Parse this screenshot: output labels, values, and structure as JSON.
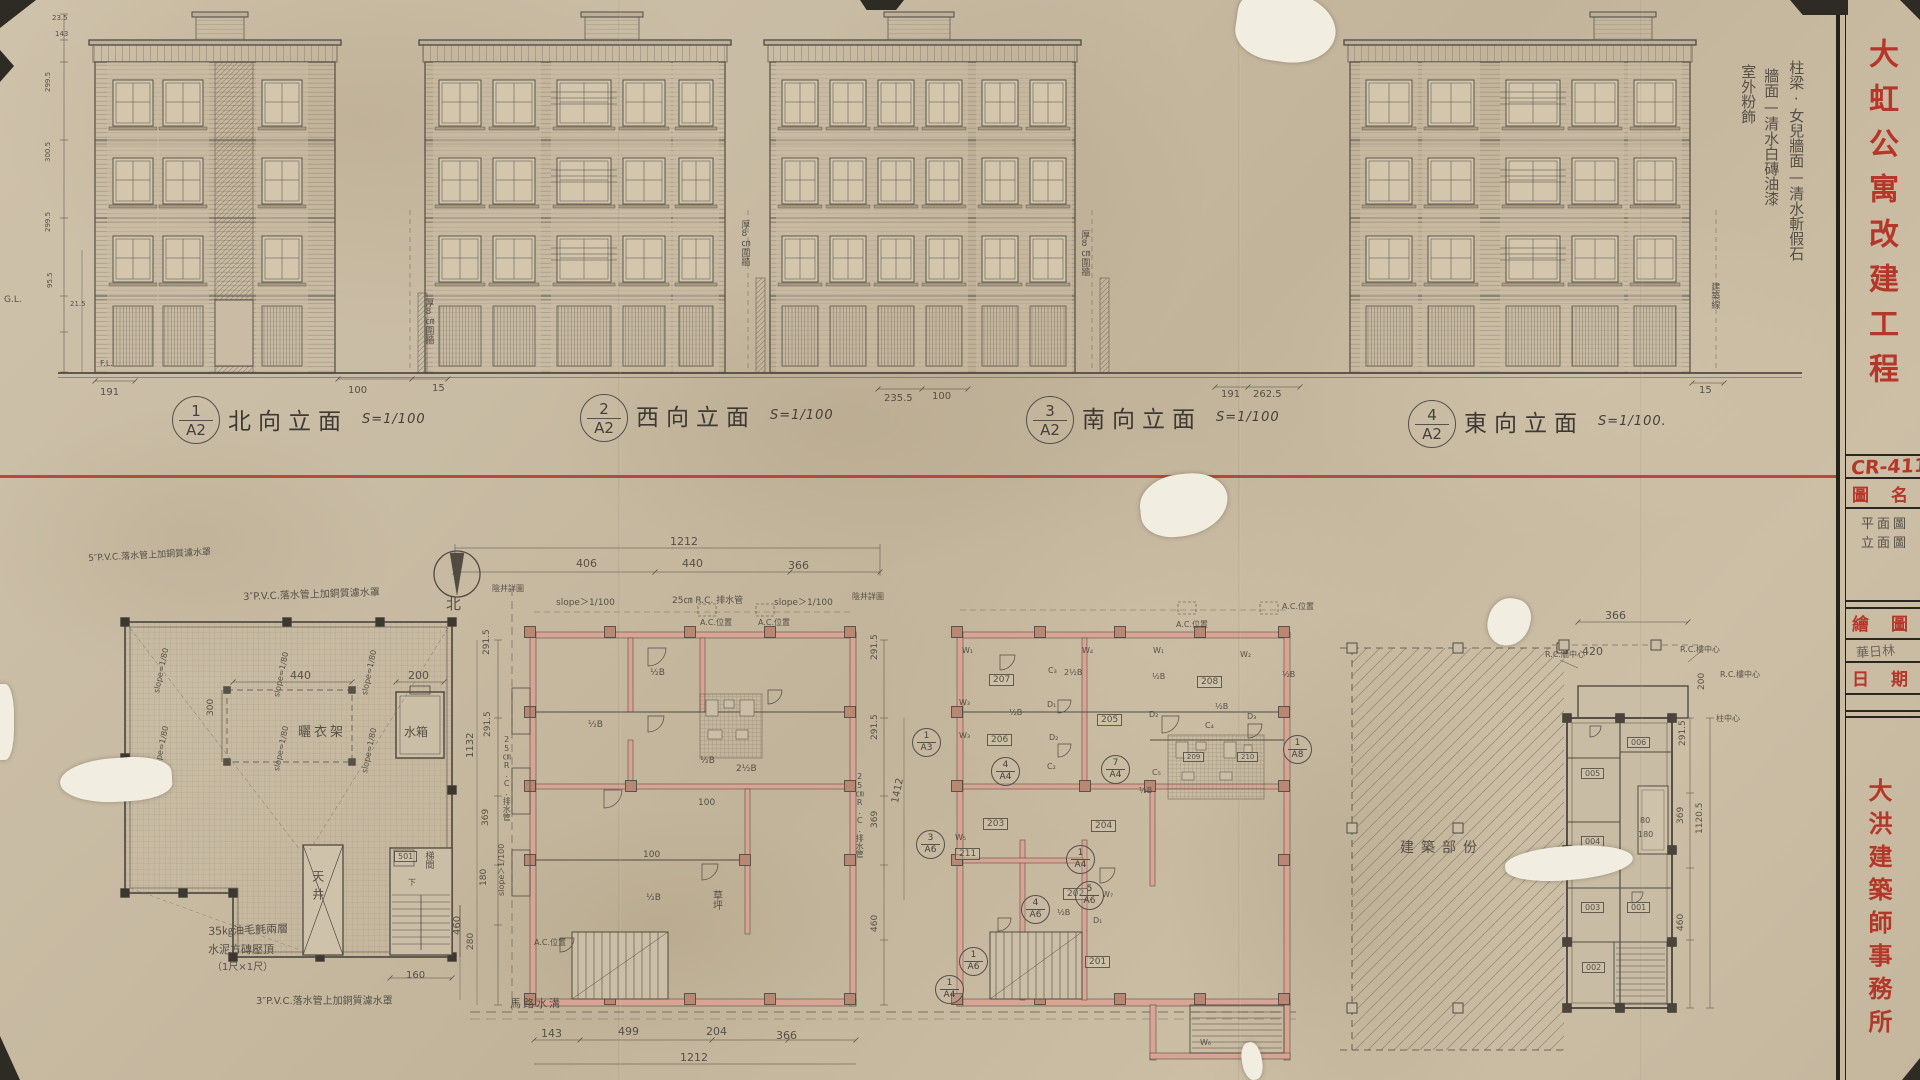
{
  "sheet": {
    "project_title": "大虹公寓改建工程",
    "drawing_no": "CR-411",
    "title_block": {
      "drawing_name_label": "圖名",
      "drawing_name_line1": "平面圖",
      "drawing_name_line2": "立面圖",
      "drafter_label": "繪圖",
      "drafter_name": "華日林",
      "date_label": "日期",
      "firm_name": "大洪建築師事務所"
    },
    "colors": {
      "red_ink": "#b5372a",
      "pencil": "#4d4840",
      "wall_fill": "#d8a595",
      "paper": "#c8baa2"
    }
  },
  "elevations": [
    {
      "num": "1",
      "sheet": "A2",
      "title": "北向立面",
      "scale": "S=1/100"
    },
    {
      "num": "2",
      "sheet": "A2",
      "title": "西向立面",
      "scale": "S=1/100"
    },
    {
      "num": "3",
      "sheet": "A2",
      "title": "南向立面",
      "scale": "S=1/100"
    },
    {
      "num": "4",
      "sheet": "A2",
      "title": "東向立面",
      "scale": "S=1/100."
    }
  ],
  "refs": [
    {
      "n": "1",
      "s": "A2",
      "x": 172,
      "y": 396,
      "d": 46,
      "nm": "elevation-ref-1"
    },
    {
      "n": "2",
      "s": "A2",
      "x": 580,
      "y": 394,
      "d": 46,
      "nm": "elevation-ref-2"
    },
    {
      "n": "3",
      "s": "A2",
      "x": 1026,
      "y": 396,
      "d": 46,
      "nm": "elevation-ref-3"
    },
    {
      "n": "4",
      "s": "A2",
      "x": 1408,
      "y": 400,
      "d": 46,
      "nm": "elevation-ref-4"
    },
    {
      "n": "1",
      "s": "A3",
      "x": 912,
      "y": 728,
      "d": 27
    },
    {
      "n": "3",
      "s": "A6",
      "x": 916,
      "y": 830,
      "d": 27
    },
    {
      "n": "1",
      "s": "A4",
      "x": 1066,
      "y": 845,
      "d": 27
    },
    {
      "n": "5",
      "s": "A6",
      "x": 1075,
      "y": 881,
      "d": 27
    },
    {
      "n": "4",
      "s": "A6",
      "x": 1021,
      "y": 895,
      "d": 27
    },
    {
      "n": "1",
      "s": "A6",
      "x": 959,
      "y": 947,
      "d": 27
    },
    {
      "n": "1",
      "s": "A4",
      "x": 935,
      "y": 975,
      "d": 27
    },
    {
      "n": "4",
      "s": "A4",
      "x": 991,
      "y": 757,
      "d": 27
    },
    {
      "n": "7",
      "s": "A4",
      "x": 1101,
      "y": 755,
      "d": 27
    },
    {
      "n": "1",
      "s": "A8",
      "x": 1283,
      "y": 735,
      "d": 27
    }
  ],
  "annotations": [
    {
      "t": "柱梁·女兒牆面—清水斬假石",
      "x": 1787,
      "y": 60,
      "v": 1,
      "s": 15,
      "n": "finish-note-structure"
    },
    {
      "t": "牆面—清水白磚油漆",
      "x": 1762,
      "y": 68,
      "v": 1,
      "s": 15,
      "n": "finish-note-wall"
    },
    {
      "t": "室外粉飾",
      "x": 1739,
      "y": 64,
      "v": 1,
      "s": 15,
      "n": "finish-note-exterior"
    },
    {
      "t": "G.L.",
      "x": 4,
      "y": 295,
      "s": 9
    },
    {
      "t": "F.L.",
      "x": 100,
      "y": 359,
      "s": 8
    },
    {
      "t": "23.5",
      "x": 52,
      "y": 14,
      "s": 7
    },
    {
      "t": "143",
      "x": 55,
      "y": 30,
      "s": 7
    },
    {
      "t": "299.5",
      "x": 44,
      "y": 92,
      "r": -90,
      "s": 7
    },
    {
      "t": "300.5",
      "x": 44,
      "y": 162,
      "r": -90,
      "s": 7
    },
    {
      "t": "299.5",
      "x": 44,
      "y": 232,
      "r": -90,
      "s": 7
    },
    {
      "t": "95.5",
      "x": 46,
      "y": 288,
      "r": -90,
      "s": 7
    },
    {
      "t": "21.5",
      "x": 70,
      "y": 300,
      "s": 7
    },
    {
      "t": "191",
      "x": 100,
      "y": 387,
      "s": 10
    },
    {
      "t": "100",
      "x": 348,
      "y": 385,
      "s": 10
    },
    {
      "t": "15",
      "x": 432,
      "y": 383,
      "s": 10
    },
    {
      "t": "235.5",
      "x": 884,
      "y": 393,
      "s": 10
    },
    {
      "t": "100",
      "x": 932,
      "y": 391,
      "s": 10
    },
    {
      "t": "191",
      "x": 1221,
      "y": 389,
      "s": 10
    },
    {
      "t": "262.5",
      "x": 1253,
      "y": 389,
      "s": 10
    },
    {
      "t": "15",
      "x": 1699,
      "y": 385,
      "s": 10
    },
    {
      "t": "厚8㎝圍牆",
      "x": 423,
      "y": 298,
      "v": 1,
      "s": 9
    },
    {
      "t": "厚8㎝圍牆",
      "x": 739,
      "y": 220,
      "v": 1,
      "s": 9
    },
    {
      "t": "厚8㎝圍牆",
      "x": 1079,
      "y": 230,
      "v": 1,
      "s": 9
    },
    {
      "t": "建築線",
      "x": 1709,
      "y": 282,
      "v": 1,
      "s": 9
    },
    {
      "t": "5″P.V.C.落水管上加銅質濾水罩",
      "x": 88,
      "y": 554,
      "s": 9,
      "r": -3
    },
    {
      "t": "3″P.V.C.落水管上加銅質濾水罩",
      "x": 243,
      "y": 592,
      "s": 10,
      "r": -2
    },
    {
      "t": "3″P.V.C.落水管上加銅質濾水罩",
      "x": 256,
      "y": 996,
      "s": 10
    },
    {
      "t": "440",
      "x": 290,
      "y": 670,
      "s": 11
    },
    {
      "t": "200",
      "x": 408,
      "y": 670,
      "s": 11
    },
    {
      "t": "300",
      "x": 206,
      "y": 716,
      "r": -90,
      "s": 9
    },
    {
      "t": "160",
      "x": 406,
      "y": 970,
      "s": 10
    },
    {
      "t": "460",
      "x": 452,
      "y": 935,
      "r": -90,
      "s": 10
    },
    {
      "t": "slope=1/80",
      "x": 152,
      "y": 692,
      "r": -78,
      "s": 8
    },
    {
      "t": "slope=1/80",
      "x": 272,
      "y": 696,
      "r": -78,
      "s": 8
    },
    {
      "t": "slope=1/80",
      "x": 360,
      "y": 694,
      "r": -78,
      "s": 8
    },
    {
      "t": "slope=1/80",
      "x": 152,
      "y": 770,
      "r": -78,
      "s": 8
    },
    {
      "t": "slope=1/80",
      "x": 272,
      "y": 770,
      "r": -78,
      "s": 8
    },
    {
      "t": "slope=1/80",
      "x": 360,
      "y": 772,
      "r": -78,
      "s": 8
    },
    {
      "t": "曬衣架",
      "x": 298,
      "y": 726,
      "s": 13,
      "ls": 3
    },
    {
      "t": "水箱",
      "x": 404,
      "y": 726,
      "s": 12
    },
    {
      "t": "天井",
      "x": 310,
      "y": 870,
      "v": 1,
      "s": 12,
      "ls": 6
    },
    {
      "t": "501",
      "x": 394,
      "y": 851,
      "b": 1,
      "s": 8
    },
    {
      "t": "梯間",
      "x": 423,
      "y": 851,
      "v": 1,
      "s": 9
    },
    {
      "t": "下",
      "x": 408,
      "y": 878,
      "s": 8
    },
    {
      "t": "35㎏油毛氈兩層",
      "x": 208,
      "y": 926,
      "s": 11,
      "r": -2
    },
    {
      "t": "水泥方磚壓頂",
      "x": 208,
      "y": 944,
      "s": 11
    },
    {
      "t": "（1尺×1尺）",
      "x": 212,
      "y": 962,
      "s": 10
    },
    {
      "t": "北",
      "x": 446,
      "y": 596,
      "s": 15,
      "n": "north-label"
    },
    {
      "t": "1212",
      "x": 670,
      "y": 536,
      "s": 11
    },
    {
      "t": "406",
      "x": 576,
      "y": 558,
      "s": 11
    },
    {
      "t": "440",
      "x": 682,
      "y": 558,
      "s": 11
    },
    {
      "t": "366",
      "x": 788,
      "y": 560,
      "s": 11
    },
    {
      "t": "slope＞1/100",
      "x": 556,
      "y": 598,
      "s": 9
    },
    {
      "t": "25㎝ R.C. 排水管",
      "x": 672,
      "y": 596,
      "s": 9
    },
    {
      "t": "陰井詳圖",
      "x": 492,
      "y": 584,
      "s": 8
    },
    {
      "t": "陰井詳圖",
      "x": 852,
      "y": 592,
      "s": 8
    },
    {
      "t": "slope＞1/100",
      "x": 774,
      "y": 598,
      "s": 9
    },
    {
      "t": "A.C.位置",
      "x": 700,
      "y": 618,
      "s": 8
    },
    {
      "t": "A.C.位置",
      "x": 758,
      "y": 618,
      "s": 8
    },
    {
      "t": "A.C.位置",
      "x": 534,
      "y": 938,
      "s": 8
    },
    {
      "t": "A.C.位置",
      "x": 1176,
      "y": 620,
      "s": 8
    },
    {
      "t": "A.C.位置",
      "x": 1282,
      "y": 602,
      "s": 8
    },
    {
      "t": "½B",
      "x": 650,
      "y": 668,
      "s": 9
    },
    {
      "t": "½B",
      "x": 588,
      "y": 720,
      "s": 9
    },
    {
      "t": "½B",
      "x": 700,
      "y": 756,
      "s": 9
    },
    {
      "t": "2½B",
      "x": 736,
      "y": 764,
      "s": 9
    },
    {
      "t": "½B",
      "x": 646,
      "y": 893,
      "s": 9
    },
    {
      "t": "100",
      "x": 698,
      "y": 798,
      "s": 9
    },
    {
      "t": "100",
      "x": 643,
      "y": 850,
      "s": 9
    },
    {
      "t": "草坪",
      "x": 710,
      "y": 890,
      "v": 1,
      "s": 10
    },
    {
      "t": "馬路水溝",
      "x": 510,
      "y": 998,
      "s": 11,
      "ls": 2
    },
    {
      "t": "143",
      "x": 541,
      "y": 1028,
      "s": 11
    },
    {
      "t": "499",
      "x": 618,
      "y": 1026,
      "s": 11
    },
    {
      "t": "204",
      "x": 706,
      "y": 1026,
      "s": 11
    },
    {
      "t": "366",
      "x": 776,
      "y": 1030,
      "s": 11
    },
    {
      "t": "1212",
      "x": 680,
      "y": 1052,
      "s": 11
    },
    {
      "t": "1132",
      "x": 465,
      "y": 758,
      "r": -90,
      "s": 10
    },
    {
      "t": "291.5",
      "x": 482,
      "y": 655,
      "r": -90,
      "s": 9
    },
    {
      "t": "291.5",
      "x": 483,
      "y": 737,
      "r": -90,
      "s": 9
    },
    {
      "t": "369",
      "x": 481,
      "y": 826,
      "r": -90,
      "s": 9
    },
    {
      "t": "180",
      "x": 479,
      "y": 886,
      "r": -90,
      "s": 9
    },
    {
      "t": "280",
      "x": 466,
      "y": 950,
      "r": -90,
      "s": 9
    },
    {
      "t": "25㎝R.C.排水管",
      "x": 502,
      "y": 735,
      "v": 1,
      "s": 8
    },
    {
      "t": "slope＞1/100",
      "x": 497,
      "y": 896,
      "r": -90,
      "s": 8
    },
    {
      "t": "291.5",
      "x": 870,
      "y": 660,
      "r": -90,
      "s": 9
    },
    {
      "t": "291.5",
      "x": 870,
      "y": 740,
      "r": -90,
      "s": 9
    },
    {
      "t": "369",
      "x": 870,
      "y": 828,
      "r": -90,
      "s": 9
    },
    {
      "t": "460",
      "x": 870,
      "y": 932,
      "r": -90,
      "s": 9
    },
    {
      "t": "1412",
      "x": 890,
      "y": 802,
      "r": -78,
      "s": 10
    },
    {
      "t": "25㎝R.C.排水管",
      "x": 855,
      "y": 772,
      "v": 1,
      "s": 8
    },
    {
      "t": "201",
      "x": 1085,
      "y": 956,
      "b": 1,
      "s": 9
    },
    {
      "t": "202",
      "x": 1063,
      "y": 888,
      "b": 1,
      "s": 9
    },
    {
      "t": "203",
      "x": 983,
      "y": 818,
      "b": 1,
      "s": 9
    },
    {
      "t": "204",
      "x": 1091,
      "y": 820,
      "b": 1,
      "s": 9
    },
    {
      "t": "205",
      "x": 1097,
      "y": 714,
      "b": 1,
      "s": 9
    },
    {
      "t": "206",
      "x": 987,
      "y": 734,
      "b": 1,
      "s": 9
    },
    {
      "t": "207",
      "x": 989,
      "y": 674,
      "b": 1,
      "s": 9
    },
    {
      "t": "208",
      "x": 1197,
      "y": 676,
      "b": 1,
      "s": 9
    },
    {
      "t": "209",
      "x": 1183,
      "y": 752,
      "b": 1,
      "s": 7
    },
    {
      "t": "210",
      "x": 1237,
      "y": 752,
      "b": 1,
      "s": 7
    },
    {
      "t": "211",
      "x": 955,
      "y": 848,
      "b": 1,
      "s": 9
    },
    {
      "t": "W₁",
      "x": 962,
      "y": 646,
      "s": 8
    },
    {
      "t": "W₄",
      "x": 1082,
      "y": 646,
      "s": 8
    },
    {
      "t": "W₁",
      "x": 1153,
      "y": 646,
      "s": 8
    },
    {
      "t": "W₂",
      "x": 1240,
      "y": 650,
      "s": 8
    },
    {
      "t": "W₃",
      "x": 959,
      "y": 698,
      "s": 8
    },
    {
      "t": "W₃",
      "x": 959,
      "y": 731,
      "s": 8
    },
    {
      "t": "W₅",
      "x": 955,
      "y": 833,
      "s": 8
    },
    {
      "t": "W₇",
      "x": 1102,
      "y": 890,
      "s": 8
    },
    {
      "t": "W₆",
      "x": 1200,
      "y": 1038,
      "s": 8
    },
    {
      "t": "D₁",
      "x": 1047,
      "y": 700,
      "s": 8
    },
    {
      "t": "D₂",
      "x": 1049,
      "y": 733,
      "s": 8
    },
    {
      "t": "D₂",
      "x": 1149,
      "y": 710,
      "s": 8
    },
    {
      "t": "D₃",
      "x": 1247,
      "y": 712,
      "s": 8
    },
    {
      "t": "D₁",
      "x": 1093,
      "y": 916,
      "s": 8
    },
    {
      "t": "C₃",
      "x": 1048,
      "y": 666,
      "s": 8
    },
    {
      "t": "C₂",
      "x": 1047,
      "y": 762,
      "s": 8
    },
    {
      "t": "C₄",
      "x": 1205,
      "y": 721,
      "s": 8
    },
    {
      "t": "C₅",
      "x": 1152,
      "y": 768,
      "s": 8
    },
    {
      "t": "2½B",
      "x": 1064,
      "y": 668,
      "s": 8
    },
    {
      "t": "½B",
      "x": 1009,
      "y": 708,
      "s": 8
    },
    {
      "t": "½B",
      "x": 1152,
      "y": 672,
      "s": 8
    },
    {
      "t": "½B",
      "x": 1215,
      "y": 702,
      "s": 8
    },
    {
      "t": "½B",
      "x": 1139,
      "y": 786,
      "s": 8
    },
    {
      "t": "½B",
      "x": 1057,
      "y": 908,
      "s": 8
    },
    {
      "t": "½B",
      "x": 1282,
      "y": 670,
      "s": 8
    },
    {
      "t": "366",
      "x": 1605,
      "y": 610,
      "s": 11
    },
    {
      "t": "R.C.牆中心",
      "x": 1545,
      "y": 650,
      "s": 8
    },
    {
      "t": "420",
      "x": 1582,
      "y": 646,
      "s": 11
    },
    {
      "t": "R.C.樓中心",
      "x": 1680,
      "y": 645,
      "s": 8
    },
    {
      "t": "R.C.樓中心",
      "x": 1720,
      "y": 670,
      "s": 8
    },
    {
      "t": "200",
      "x": 1697,
      "y": 690,
      "r": -90,
      "s": 9
    },
    {
      "t": "柱中心",
      "x": 1716,
      "y": 714,
      "s": 8
    },
    {
      "t": "291.5",
      "x": 1678,
      "y": 746,
      "r": -90,
      "s": 9
    },
    {
      "t": "369",
      "x": 1676,
      "y": 824,
      "r": -90,
      "s": 9
    },
    {
      "t": "1120.5",
      "x": 1695,
      "y": 834,
      "r": -90,
      "s": 9
    },
    {
      "t": "80",
      "x": 1640,
      "y": 816,
      "s": 8
    },
    {
      "t": "180",
      "x": 1638,
      "y": 830,
      "s": 8
    },
    {
      "t": "460",
      "x": 1676,
      "y": 931,
      "r": -90,
      "s": 9
    },
    {
      "t": "006",
      "x": 1627,
      "y": 737,
      "b": 1,
      "s": 8
    },
    {
      "t": "005",
      "x": 1581,
      "y": 768,
      "b": 1,
      "s": 8
    },
    {
      "t": "004",
      "x": 1581,
      "y": 836,
      "b": 1,
      "s": 8
    },
    {
      "t": "003",
      "x": 1581,
      "y": 902,
      "b": 1,
      "s": 8
    },
    {
      "t": "001",
      "x": 1627,
      "y": 902,
      "b": 1,
      "s": 8
    },
    {
      "t": "002",
      "x": 1582,
      "y": 962,
      "b": 1,
      "s": 8
    },
    {
      "t": "建築部份",
      "x": 1400,
      "y": 840,
      "s": 14,
      "ls": 7,
      "n": "new-construction-label"
    }
  ]
}
